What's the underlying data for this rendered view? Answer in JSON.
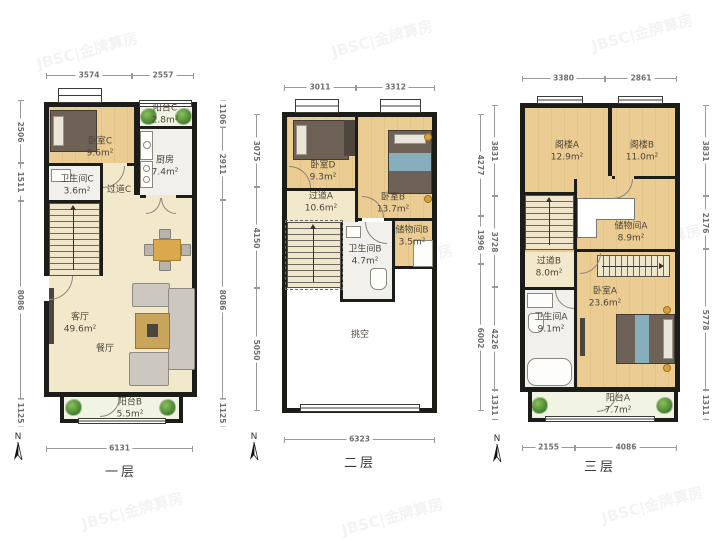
{
  "watermark": "JBSC|金牌算房",
  "compass": "N",
  "palette": {
    "wall": "#1c1c19",
    "wood_floor": "#ebcd93",
    "cream_floor": "#f2e9cd",
    "tile_floor": "#f1f0ec",
    "balcony_floor": "#f1f4e2",
    "plant_green": "#3f7d2c",
    "dimension_gray": "#6e6e6a"
  },
  "floors": [
    {
      "name": "一层",
      "dims": {
        "top": [
          "3574",
          "2557"
        ],
        "bottom": [
          "6131"
        ],
        "left": [
          "2506",
          "1511",
          "8086",
          "1125"
        ],
        "right": [
          "1106",
          "2911",
          "8086",
          "1125"
        ]
      },
      "rooms": {
        "bedroomC": {
          "label": "卧室C",
          "area": "9.6m²"
        },
        "balconyC": {
          "label": "阳台C",
          "area": "2.8m²"
        },
        "kitchen": {
          "label": "厨房",
          "area": "7.4m²"
        },
        "bathroomC": {
          "label": "卫生间C",
          "area": "3.6m²"
        },
        "hallwayC": {
          "label": "过道C",
          "area": ""
        },
        "livingRoom": {
          "label": "客厅",
          "area": "49.6m²"
        },
        "diningRoom": {
          "label": "餐厅",
          "area": ""
        },
        "balconyB": {
          "label": "阳台B",
          "area": "5.5m²"
        }
      }
    },
    {
      "name": "二层",
      "dims": {
        "top": [
          "3011",
          "3312"
        ],
        "bottom": [
          "6323"
        ],
        "left": [
          "3075",
          "4150",
          "5050"
        ],
        "right": [
          "4277",
          "1996",
          "6002"
        ]
      },
      "rooms": {
        "bedroomD": {
          "label": "卧室D",
          "area": "9.3m²"
        },
        "bedroomB": {
          "label": "卧室B",
          "area": "13.7m²"
        },
        "hallwayA": {
          "label": "过道A",
          "area": "10.6m²"
        },
        "bathroomB": {
          "label": "卫生间B",
          "area": "4.7m²"
        },
        "storageB": {
          "label": "储物间B",
          "area": "3.5m²"
        },
        "void": {
          "label": "挑空",
          "area": ""
        }
      }
    },
    {
      "name": "三层",
      "dims": {
        "top": [
          "3380",
          "2861"
        ],
        "bottom": [
          "2155",
          "4086"
        ],
        "left": [
          "3831",
          "3728",
          "4226",
          "1311"
        ],
        "right": [
          "3831",
          "2176",
          "5778",
          "1311"
        ]
      },
      "rooms": {
        "atticA": {
          "label": "阁楼A",
          "area": "12.9m²"
        },
        "atticB": {
          "label": "阁楼B",
          "area": "11.0m²"
        },
        "storageA": {
          "label": "储物间A",
          "area": "8.9m²"
        },
        "hallwayB": {
          "label": "过道B",
          "area": "8.0m²"
        },
        "bathroomA": {
          "label": "卫生间A",
          "area": "9.1m²"
        },
        "bedroomA": {
          "label": "卧室A",
          "area": "23.6m²"
        },
        "balconyA": {
          "label": "阳台A",
          "area": "7.7m²"
        }
      }
    }
  ]
}
